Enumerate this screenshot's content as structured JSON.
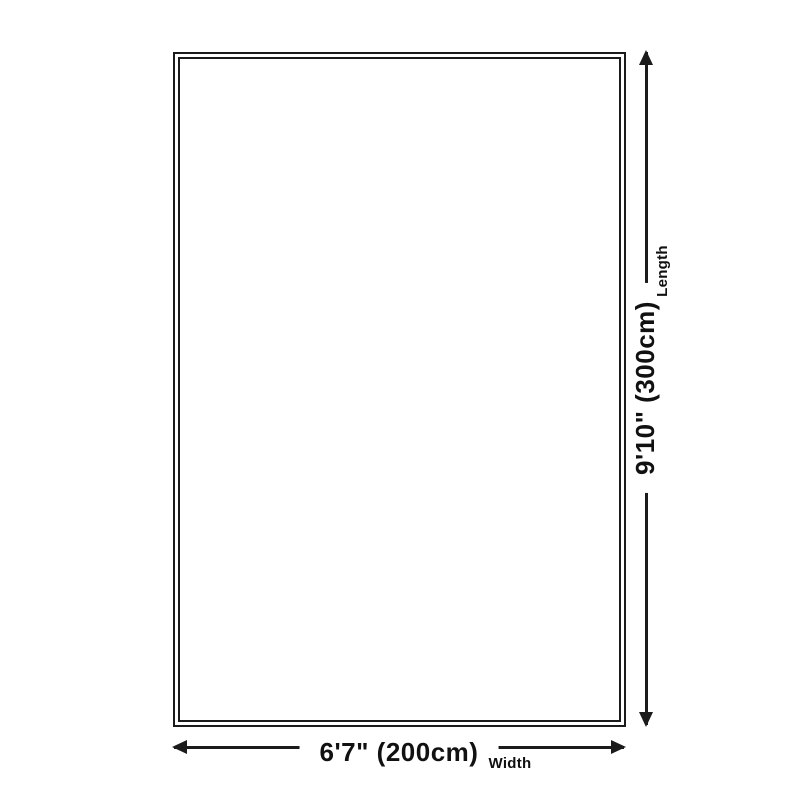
{
  "colors": {
    "line": "#1b1b1b",
    "text": "#111111",
    "background": "#ffffff"
  },
  "width_dimension": {
    "value": "6'7\" (200cm)",
    "label": "Width"
  },
  "length_dimension": {
    "value": "9'10\" (300cm)",
    "label": "Length"
  }
}
